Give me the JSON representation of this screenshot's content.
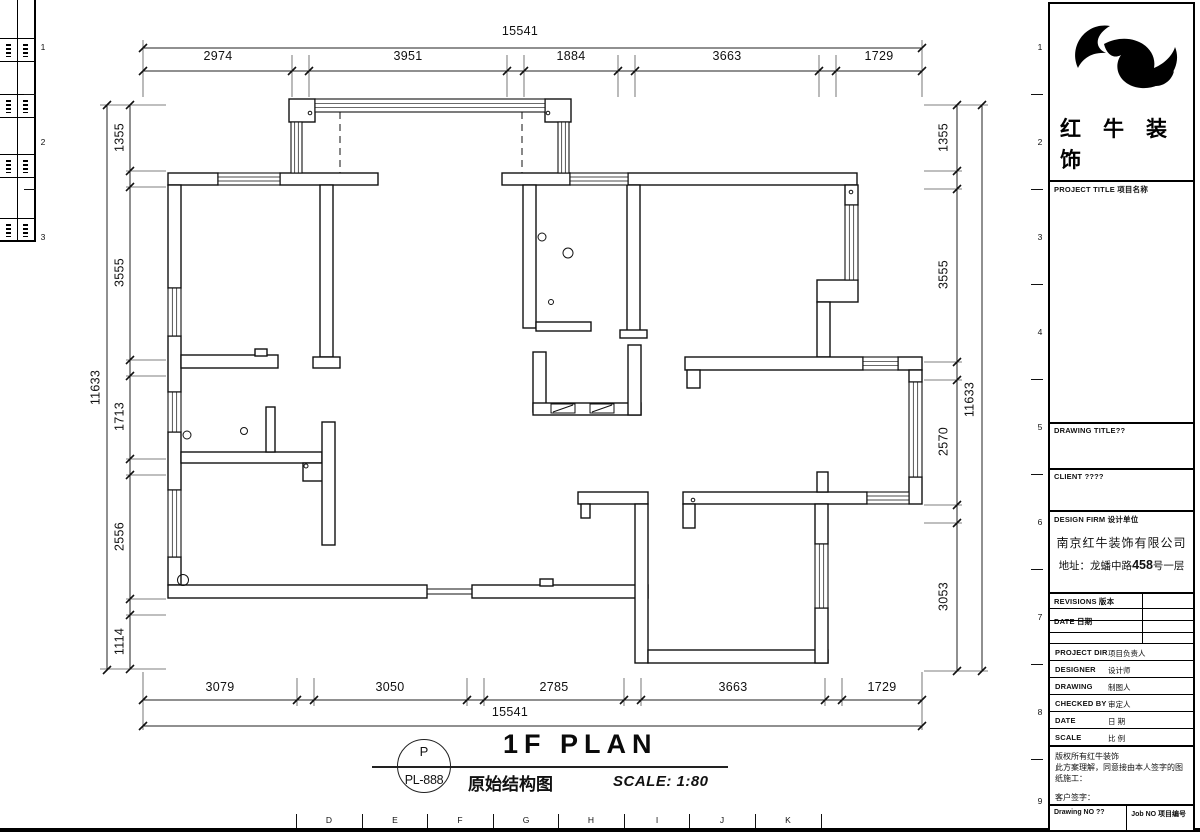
{
  "plan": {
    "title": {
      "bubble_top": "P",
      "bubble_bottom": "PL-888",
      "heading": "1F PLAN",
      "subtitle": "原始结构图",
      "scale": "SCALE: 1:80"
    },
    "dims": {
      "top_total": "15541",
      "top_segments": [
        "2974",
        "3951",
        "1884",
        "3663",
        "1729"
      ],
      "bottom_total": "15541",
      "bottom_segments": [
        "3079",
        "3050",
        "2785",
        "3663",
        "1729"
      ],
      "left_total": "11633",
      "left_segments": [
        "1355",
        "3555",
        "1713",
        "2556",
        "1114"
      ],
      "right_total": "11633",
      "right_segments": [
        "1355",
        "3555",
        "2570",
        "3053"
      ]
    }
  },
  "frame": {
    "bottom_letters": [
      "D",
      "E",
      "F",
      "G",
      "H",
      "I",
      "J",
      "K"
    ],
    "right_numbers": [
      "1",
      "2",
      "3",
      "4",
      "5",
      "6",
      "7",
      "8",
      "9"
    ],
    "left_numbers": [
      "1",
      "2",
      "3"
    ]
  },
  "title_block": {
    "brand": "红牛装饰",
    "project_title": "PROJECT TITLE 项目名称",
    "drawing_title": "DRAWING TITLE??",
    "client": "CLIENT ????",
    "design_firm": "DESIGN FIRM 设计单位",
    "company": "南京红牛装饰有限公司",
    "address_prefix": "地址：龙蟠中路",
    "address_number": "458",
    "address_suffix": "号一层",
    "revisions": "REVISIONS 版本",
    "date_col": "DATE 日期",
    "rows": {
      "project_dir_label": "PROJECT DIR",
      "project_dir_cn": "项目负责人",
      "designer_label": "DESIGNER",
      "designer_cn": "设计师",
      "drawing_label": "DRAWING",
      "drawing_cn": "制图人",
      "checked_label": "CHECKED BY",
      "checked_cn": "审定人",
      "date_label": "DATE",
      "date_cn": "日 期",
      "scale_label": "SCALE",
      "scale_cn": "比 例"
    },
    "notes": {
      "line1": "版权所有红牛装饰",
      "line2": "此方案理解，同意接由本人签字的图纸施工：",
      "line3": "客户签字："
    },
    "footer": {
      "drawing_no": "Drawing NO ??",
      "job_no": "Job NO 项目编号"
    }
  }
}
